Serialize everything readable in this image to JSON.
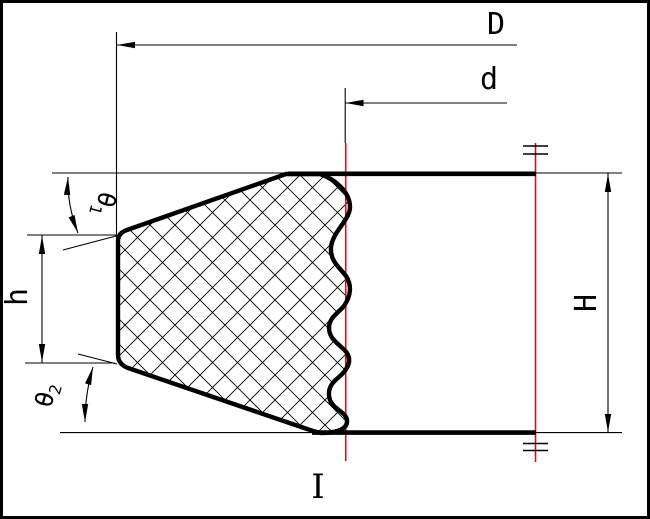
{
  "diagram": {
    "kind": "engineering cross-section of seal ring with hatched section and dimension lines",
    "colors": {
      "line": "#000000",
      "centerline": "#ff0000",
      "background": "#ffffff"
    },
    "labels": {
      "outer_diameter": "D",
      "inner_diameter": "d",
      "total_height": "H",
      "lip_height": "h",
      "theta1": {
        "base": "θ",
        "sub": "1"
      },
      "theta2": {
        "base": "θ",
        "sub": "2"
      },
      "section_mark": "I"
    }
  }
}
